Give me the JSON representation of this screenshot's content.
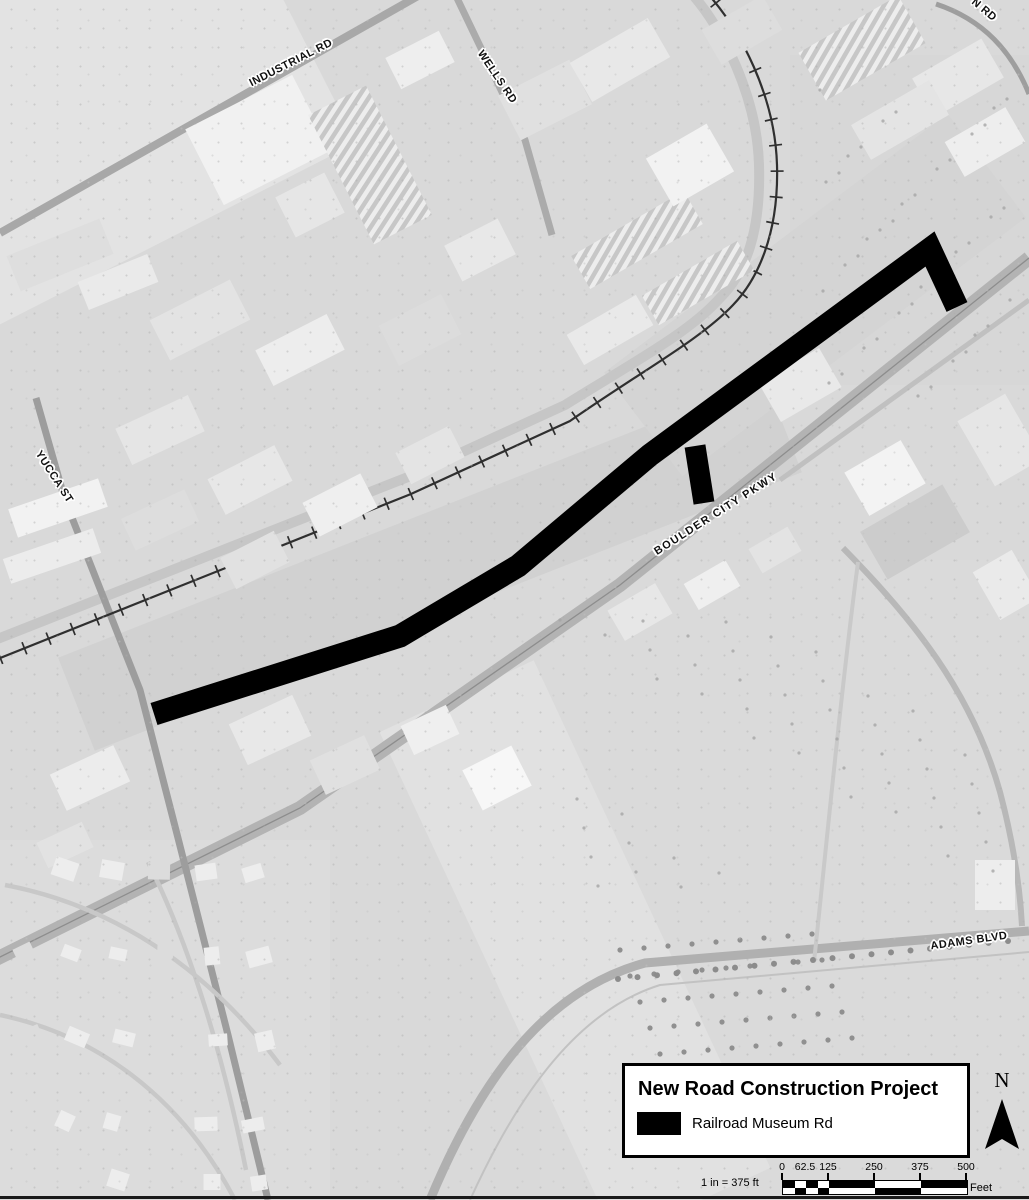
{
  "map": {
    "overlay_feature": {
      "name": "Railroad Museum Rd",
      "color": "#000000"
    },
    "road_labels": [
      {
        "id": "industrial-rd",
        "text": "INDUSTRIAL RD"
      },
      {
        "id": "wells-rd",
        "text": "WELLS RD"
      },
      {
        "id": "n-rd-partial",
        "text": "N RD"
      },
      {
        "id": "yucca-st",
        "text": "YUCCA ST"
      },
      {
        "id": "boulder-city-pkwy",
        "text": "BOULDER CITY PKWY"
      },
      {
        "id": "adams-blvd",
        "text": "ADAMS BLVD"
      }
    ]
  },
  "legend": {
    "title": "New Road Construction Project",
    "items": [
      {
        "label": "Railroad Museum Rd",
        "swatch_color": "#000000"
      }
    ]
  },
  "north_arrow": {
    "label": "N"
  },
  "scale_bar": {
    "ratio_text": "1 in = 375 ft",
    "tick_labels": [
      "0",
      "62.5",
      "125",
      "250",
      "375",
      "500"
    ],
    "unit_label": "Feet"
  }
}
